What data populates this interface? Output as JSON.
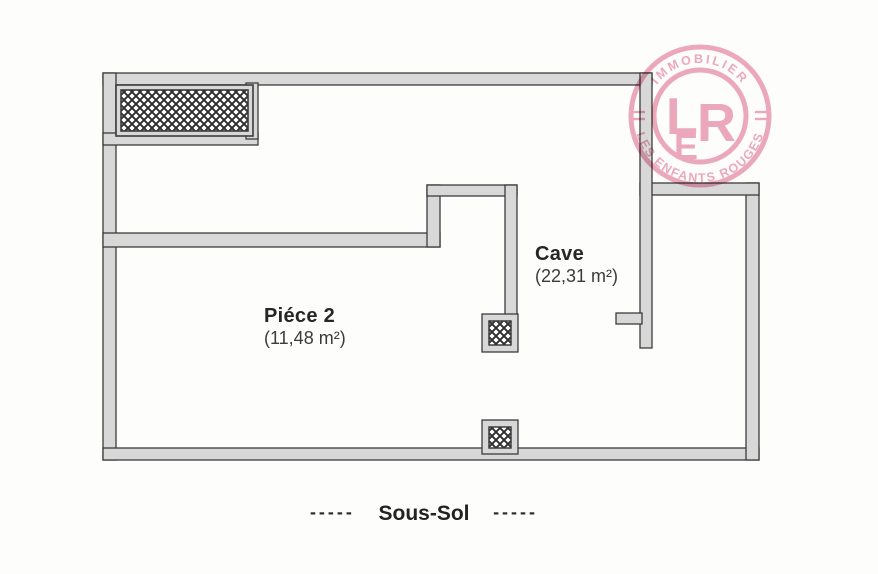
{
  "plan": {
    "caption": {
      "left_dashes": "-----",
      "floor": "Sous-Sol",
      "right_dashes": "-----"
    },
    "rooms": [
      {
        "name": "Piéce 2",
        "area": "(11,48 m²)"
      },
      {
        "name": "Cave",
        "area": "(22,31 m²)"
      }
    ],
    "colors": {
      "wall_fill": "#d8d8d8",
      "wall_stroke": "#3c3c3c",
      "hatch_line": "#2e2e2e",
      "label_text": "#262626"
    }
  },
  "stamp": {
    "top_text": "IMMOBILIER",
    "bottom_text": "LES ENFANTS ROUGES",
    "monogram": {
      "l": "L",
      "e": "E",
      "r": "R"
    },
    "color": "#ec9db4"
  }
}
